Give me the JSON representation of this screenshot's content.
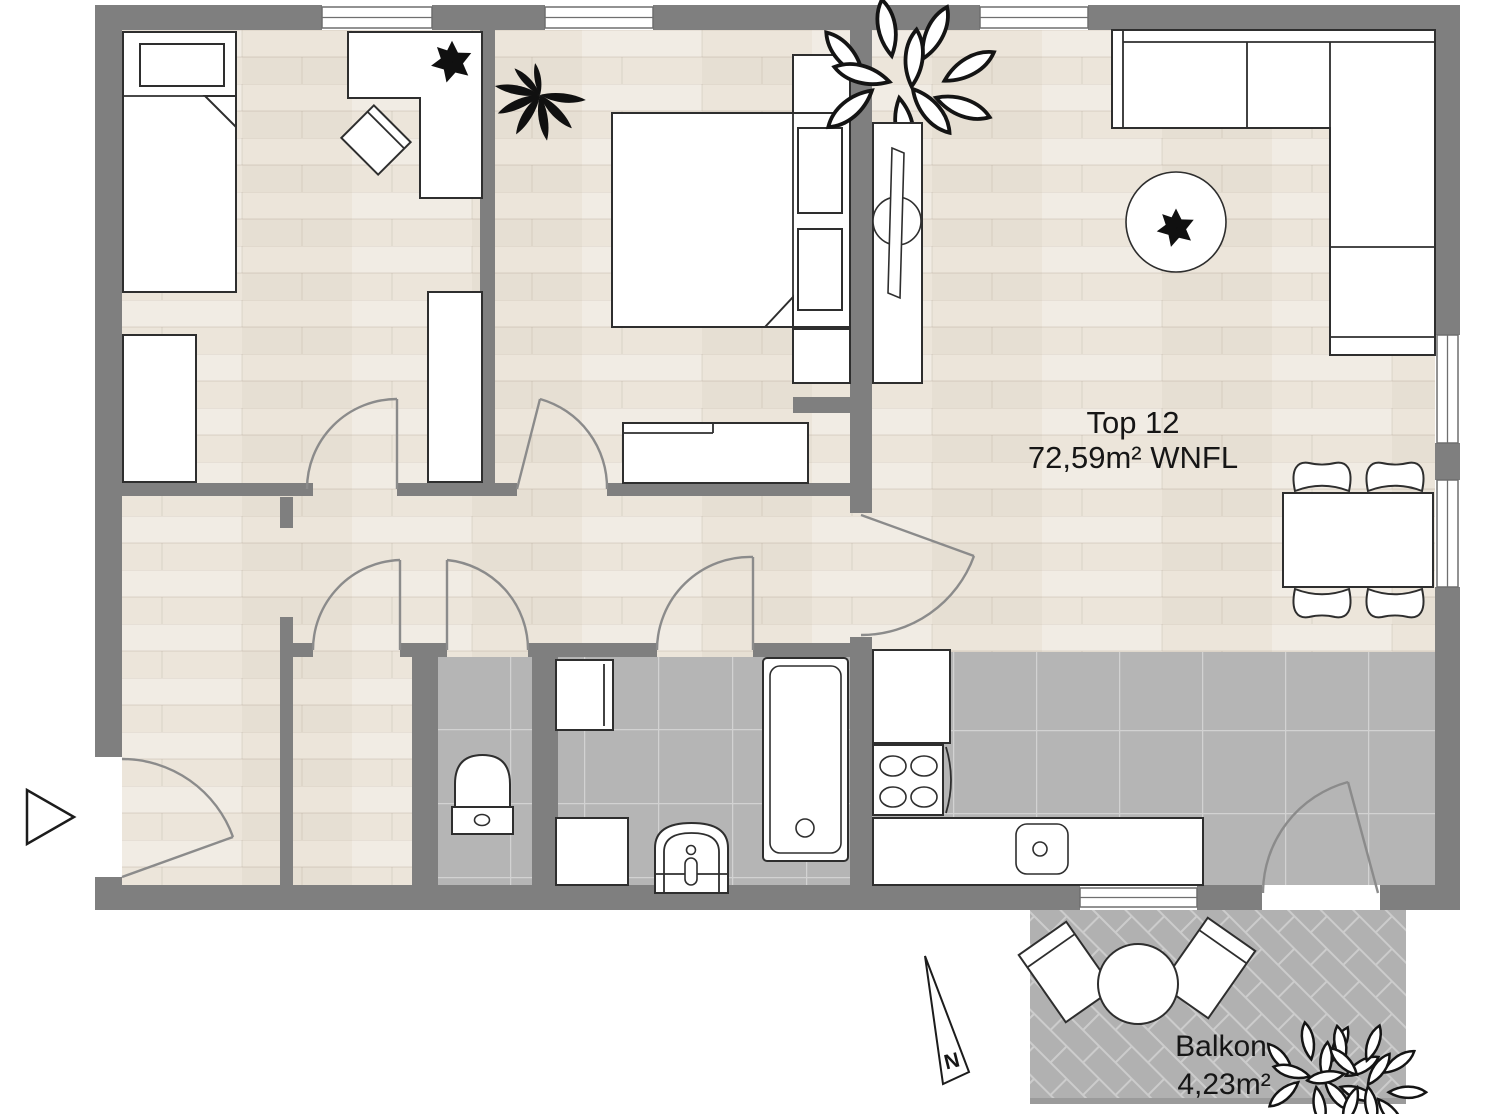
{
  "unit_label": {
    "line1": "Top 12",
    "line2": "72,59m² WNFL"
  },
  "balcony_label": {
    "line1": "Balkon",
    "line2": "4,23m²"
  },
  "north_indicator": "N",
  "colors": {
    "wall": "#7f7f7f",
    "wood": "#ece5da",
    "tile": "#b5b5b5",
    "balcony": "#b1b1b1",
    "line": "#2e2e2e",
    "door": "#8b8b8b",
    "grout": "#d2d2d2",
    "paver_joint": "#cccccc",
    "text": "#161616"
  }
}
